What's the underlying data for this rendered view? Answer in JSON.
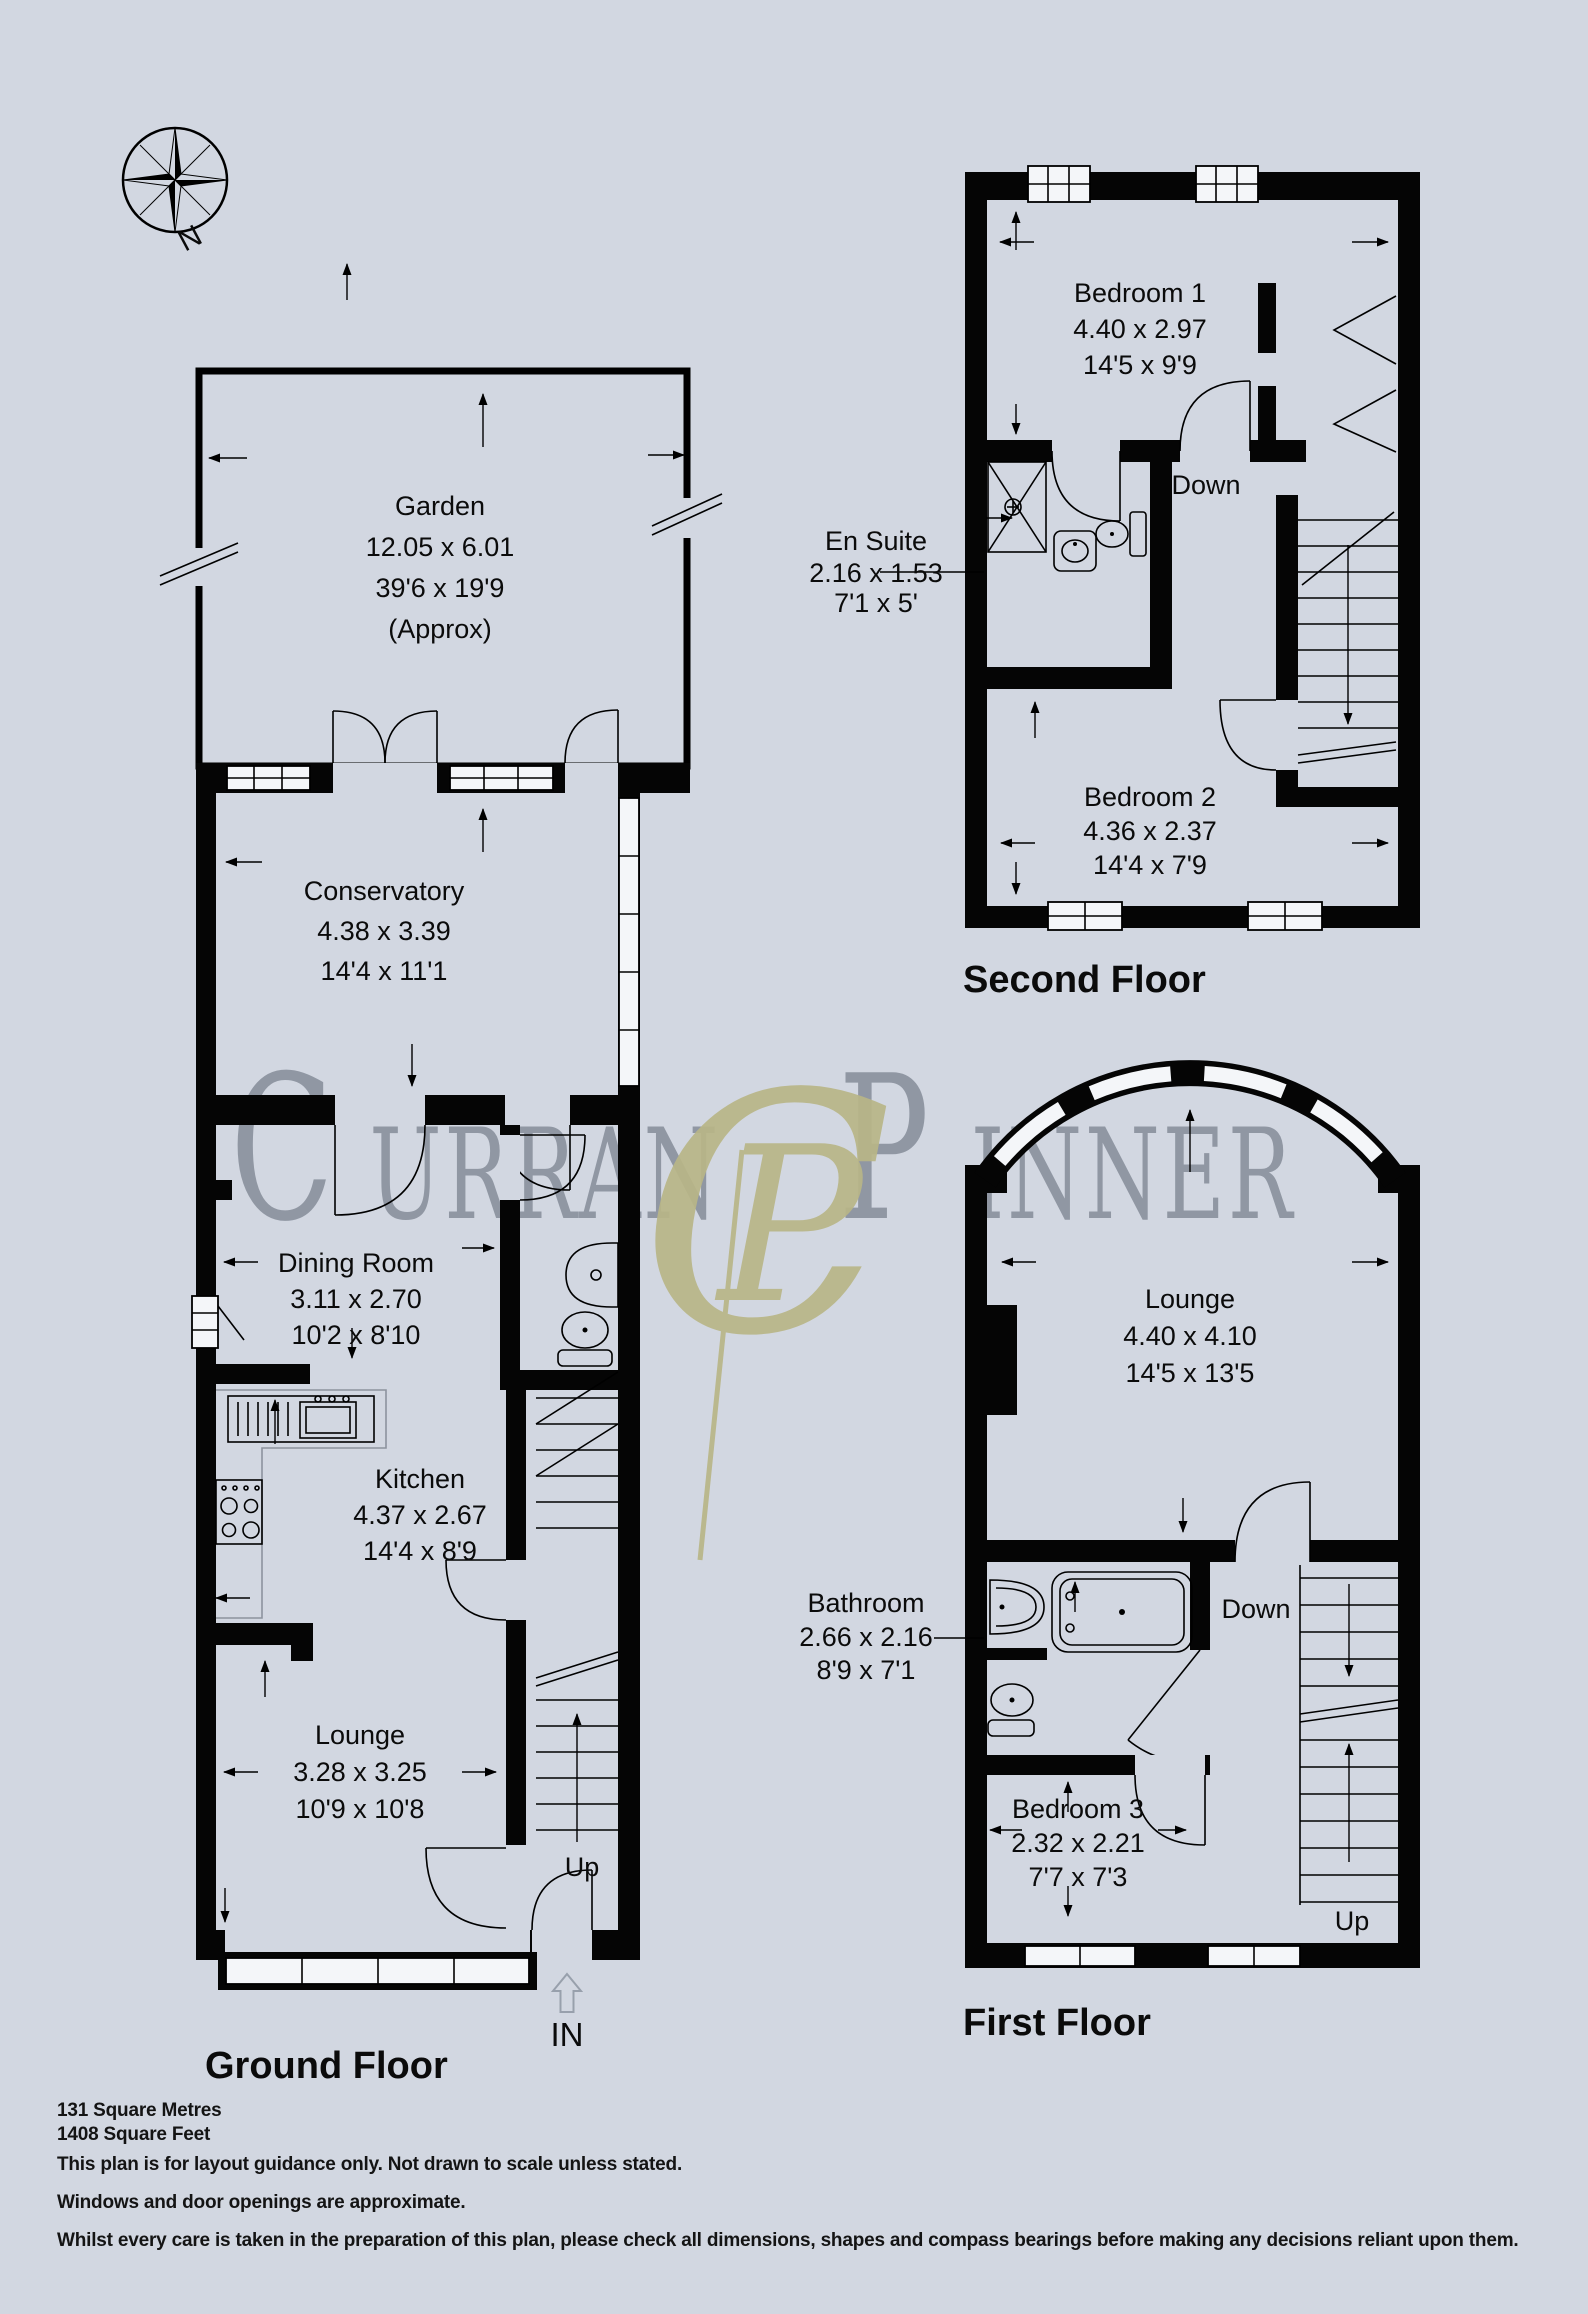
{
  "compass": {
    "north_label": "N"
  },
  "watermark": {
    "part1_initial": "C",
    "part1_rest": "URRAN",
    "monogram_c": "C",
    "monogram_p": "P",
    "part2_initial": "P",
    "part2_rest": "INNER"
  },
  "floors": {
    "ground": {
      "title": "Ground Floor",
      "stairs_up_label": "Up",
      "entrance_label": "IN",
      "rooms": {
        "garden": {
          "name": "Garden",
          "metric": "12.05 x 6.01",
          "imperial": "39'6 x 19'9",
          "note": "(Approx)"
        },
        "conservatory": {
          "name": "Conservatory",
          "metric": "4.38 x 3.39",
          "imperial": "14'4 x 11'1"
        },
        "dining": {
          "name": "Dining Room",
          "metric": "3.11 x 2.70",
          "imperial": "10'2 x 8'10"
        },
        "kitchen": {
          "name": "Kitchen",
          "metric": "4.37 x 2.67",
          "imperial": "14'4 x 8'9"
        },
        "lounge": {
          "name": "Lounge",
          "metric": "3.28 x 3.25",
          "imperial": "10'9 x 10'8"
        }
      }
    },
    "first": {
      "title": "First Floor",
      "stairs_down_label": "Down",
      "stairs_up_label": "Up",
      "rooms": {
        "lounge": {
          "name": "Lounge",
          "metric": "4.40 x 4.10",
          "imperial": "14'5 x 13'5"
        },
        "bathroom": {
          "name": "Bathroom",
          "metric": "2.66 x 2.16",
          "imperial": "8'9 x 7'1"
        },
        "bedroom3": {
          "name": "Bedroom 3",
          "metric": "2.32 x 2.21",
          "imperial": "7'7 x 7'3"
        }
      }
    },
    "second": {
      "title": "Second Floor",
      "stairs_down_label": "Down",
      "rooms": {
        "bedroom1": {
          "name": "Bedroom 1",
          "metric": "4.40 x 2.97",
          "imperial": "14'5 x 9'9"
        },
        "ensuite": {
          "name": "En Suite",
          "metric": "2.16 x 1.53",
          "imperial": "7'1 x 5'"
        },
        "bedroom2": {
          "name": "Bedroom 2",
          "metric": "4.36 x 2.37",
          "imperial": "14'4 x 7'9"
        }
      }
    }
  },
  "footer": {
    "area_metric": "131 Square Metres",
    "area_imperial": "1408 Square Feet",
    "disclaimer1": "This plan is for layout guidance only. Not drawn to scale unless stated.",
    "disclaimer2": "Windows and door openings are approximate.",
    "disclaimer3": "Whilst every care is taken in the preparation of this plan, please check all dimensions, shapes and compass bearings before making any decisions reliant upon them."
  }
}
